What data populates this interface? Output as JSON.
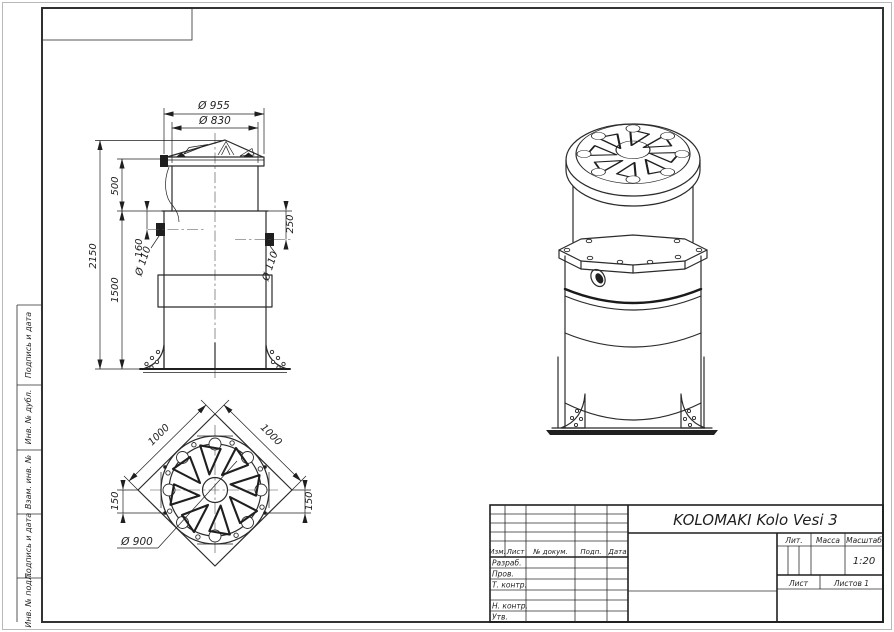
{
  "drawing": {
    "title": "KOLOMAKI Kolo Vesi 3",
    "front_view": {
      "dia_lid_outer": "Ø 955",
      "dia_lid_inner": "Ø 830",
      "height_total": "2150",
      "height_neck": "500",
      "inlet_offset_left": "160",
      "inlet_dia_left": "Ø 110",
      "height_body": "1500",
      "inlet_offset_right": "250",
      "inlet_dia_right": "Ø 110"
    },
    "top_view": {
      "base_side_left": "1000",
      "base_side_right": "1000",
      "offset_left": "150",
      "offset_right": "150",
      "dia_cover": "Ø 900"
    },
    "title_block": {
      "columns": [
        "Изм.",
        "Лист",
        "№ докум.",
        "Подп.",
        "Дата"
      ],
      "rows": [
        "Разраб.",
        "Пров.",
        "Т. контр.",
        "Н. контр.",
        "Утв."
      ],
      "lit_label": "Лит.",
      "mass_label": "Масса",
      "scale_label": "Масштаб",
      "scale_value": "1:20",
      "sheet_label": "Лист",
      "sheets_label": "Листов 1"
    },
    "margin_cells": [
      "Подпись и дата",
      "Инв. № дубл.",
      "Взам. инв. №",
      "Подпись и дата",
      "Инв. № подл."
    ]
  }
}
